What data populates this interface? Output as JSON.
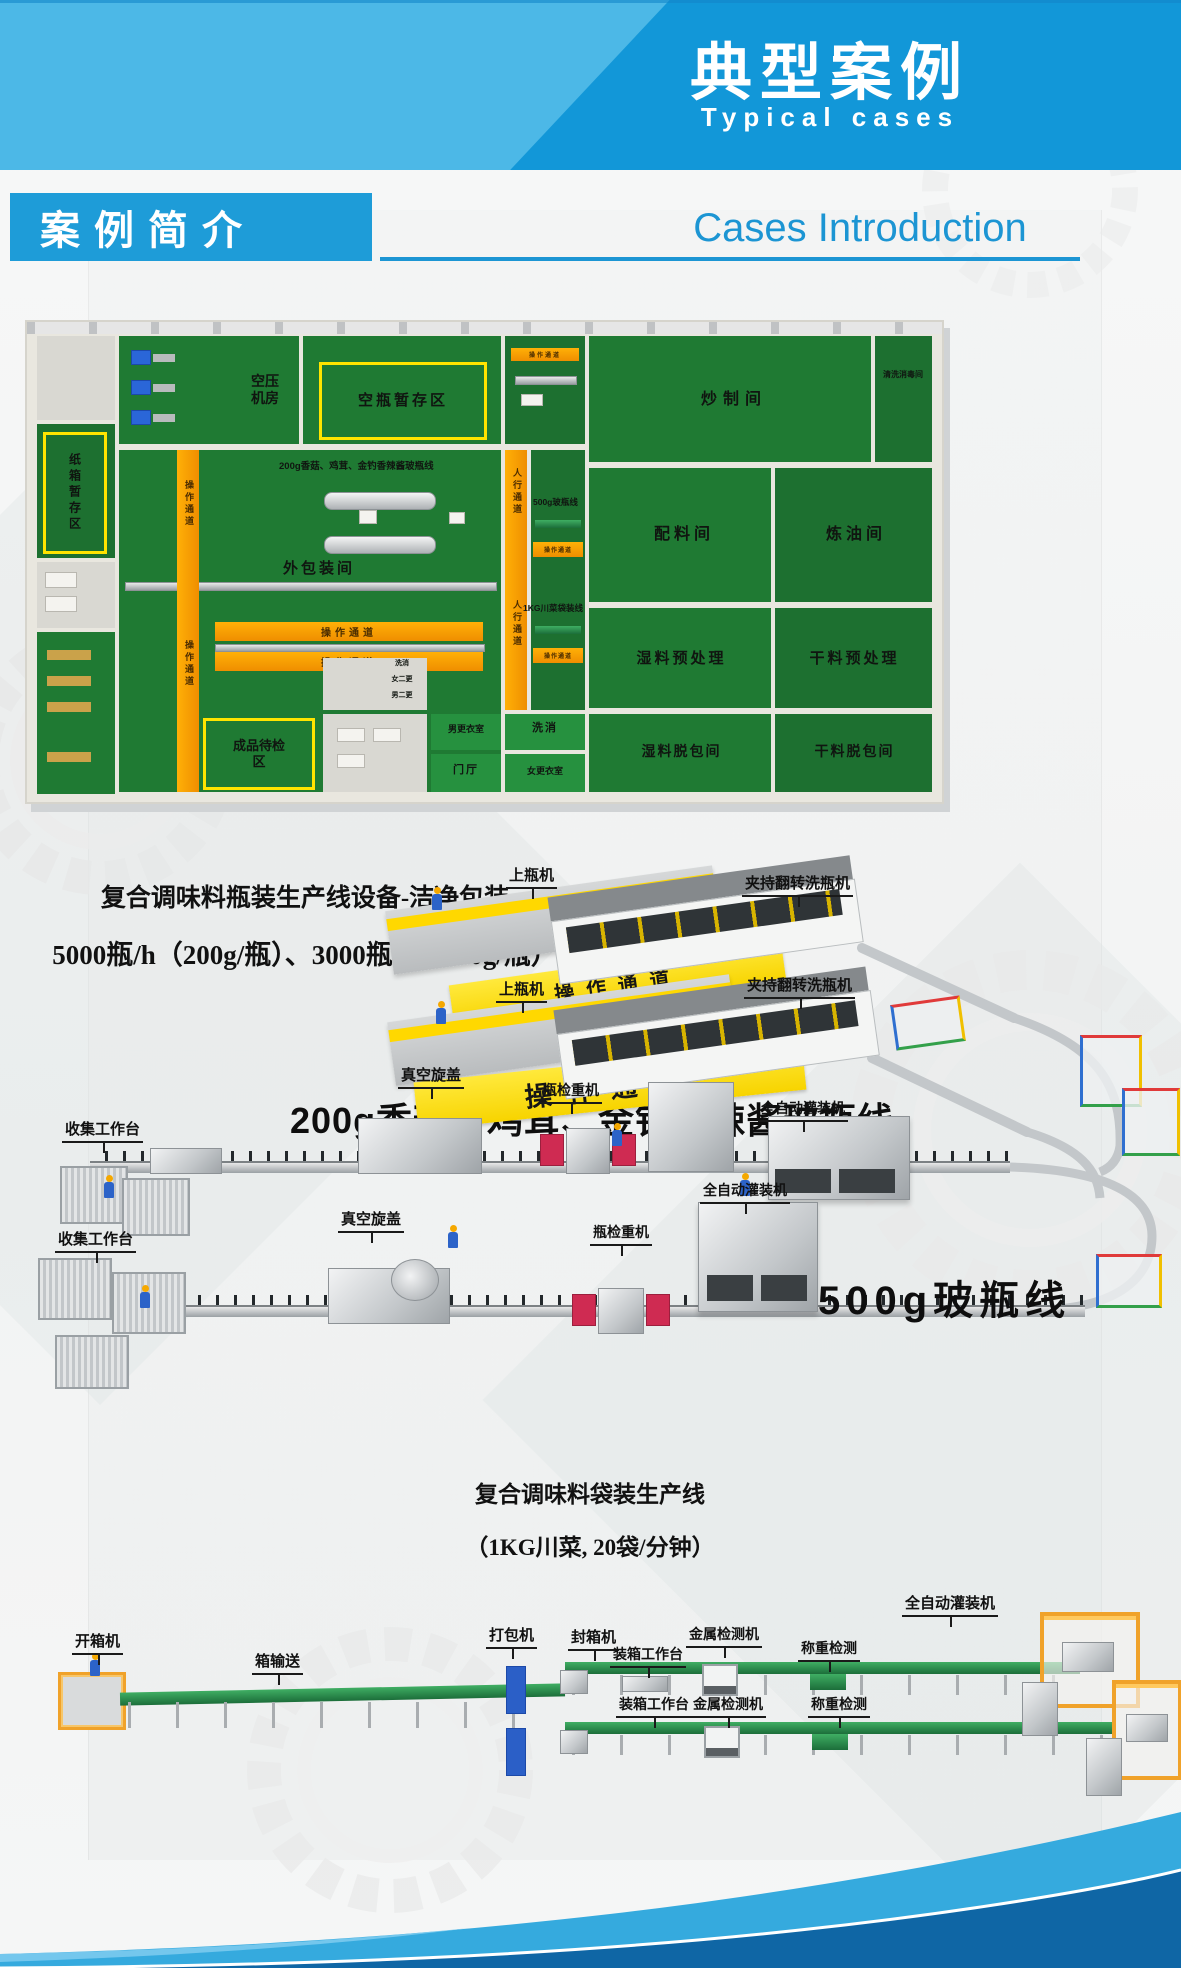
{
  "header": {
    "title": "典型案例",
    "subtitle": "Typical cases"
  },
  "intro": {
    "box_label": "案例简介",
    "heading_en": "Cases Introduction"
  },
  "colors": {
    "brand_blue": "#1e9cd8",
    "light_blue": "#4cb8e7",
    "footer_dark_blue": "#0f66a5",
    "floor_green": "#1f7a33",
    "walkway_orange": "#f29400",
    "belt_green": "#2f9e57",
    "guard_red": "#cf2b52"
  },
  "floorplan": {
    "rooms": {
      "air_compressor": "空压机房",
      "empty_bottle_storage": "空瓶暂存区",
      "frying": "炒制间",
      "ingredient": "配料间",
      "oil_refining": "炼油间",
      "tool_washing": "清洗消毒间",
      "wet_pretreatment": "湿料预处理",
      "dry_pretreatment": "干料预处理",
      "wet_debagging": "湿料脱包间",
      "dry_debagging": "干料脱包间",
      "carton_storage": "纸箱暂存区",
      "outer_packaging": "外包装间",
      "finished_inspection": "成品待检区",
      "men_changing": "男更衣室",
      "washing": "洗消",
      "lobby": "门厅",
      "women_changing": "女更衣室",
      "women_second_changing": "女二更",
      "men_second_changing": "男二更"
    },
    "lines": {
      "line_200g": "200g香菇、鸡茸、金钓香辣酱玻瓶线",
      "line_500g": "500g玻瓶线",
      "line_1kg": "1KG川菜袋装线"
    },
    "walkways": {
      "operation": "操作通道",
      "pedestrian": "人行通道"
    }
  },
  "bottling": {
    "title_line1": "复合调味料瓶装生产线设备-洁净包装",
    "title_line2": "5000瓶/h（200g/瓶）、3000瓶/h（350g/瓶）",
    "line_200g_name": "200g香菇、鸡茸、金钓香辣酱玻瓶线",
    "line_500g_name": "500g玻瓶线",
    "labels": {
      "bottle_loader": "上瓶机",
      "clamp_flip_washer": "夹持翻转洗瓶机",
      "operation_channel": "操作通道",
      "auto_filler": "全自动灌装机",
      "checkweigher": "瓶检重机",
      "vacuum_capper": "真空旋盖",
      "collection_table": "收集工作台"
    }
  },
  "bagging": {
    "title_line1": "复合调味料袋装生产线",
    "title_line2": "（1KG川菜, 20袋/分钟）",
    "labels": {
      "carton_opener": "开箱机",
      "carton_conveyor": "箱输送",
      "strapping": "打包机",
      "sealer": "封箱机",
      "packing_table": "装箱工作台",
      "metal_detector": "金属检测机",
      "weight_checker": "称重检测",
      "palletizer_label": "全自动灌装机"
    }
  }
}
